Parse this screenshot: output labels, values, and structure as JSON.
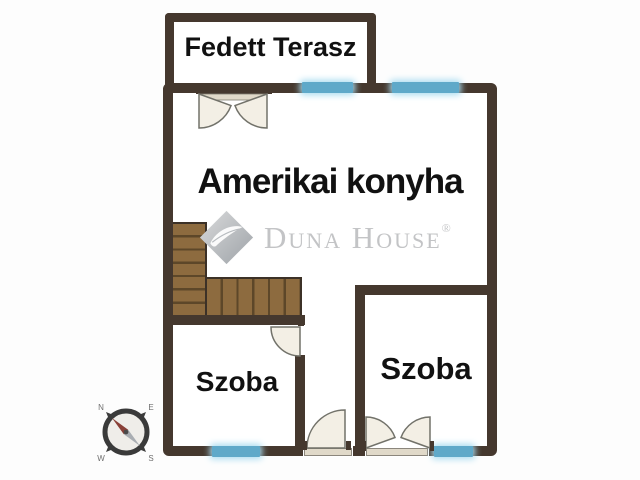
{
  "page": {
    "background": "#fdfdfd"
  },
  "colors": {
    "page_bg": "#fdfdfd",
    "wall": "#45382e",
    "window": "#5fa9c9",
    "window_glow": "#a9dcf0",
    "stair": "#8d6b3f",
    "stair_line": "#5d4729",
    "stair_outline": "#3c3127",
    "door_fill": "#f3efe5",
    "door_stroke": "#72726a",
    "door_track": "#e0d9c9",
    "label_text": "#111111",
    "watermark": "#c3c4c6"
  },
  "labels": {
    "terrace": "Fedett Terasz",
    "kitchen": "Amerikai konyha",
    "room_left": "Szoba",
    "room_right": "Szoba"
  },
  "watermark": {
    "brand": "Duna House",
    "registered_mark": "®"
  },
  "compass": {
    "north": "N",
    "east": "E",
    "south": "S",
    "west": "W"
  }
}
